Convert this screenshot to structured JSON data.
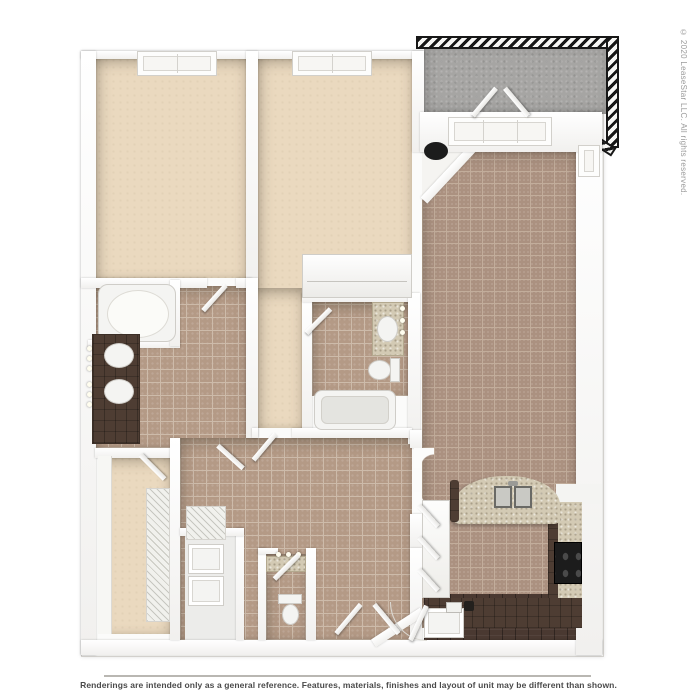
{
  "image": {
    "type": "3d-apartment-floor-plan-rendering",
    "disclaimer": "Renderings are intended only as a general reference. Features, materials, finishes and layout of unit may be different than shown.",
    "copyright": "© 2020 LeaseStar LLC. All rights reserved."
  },
  "floorplan": {
    "rooms": [
      "bedroom-1",
      "bedroom-2",
      "living-dining-room",
      "kitchen",
      "master-bathroom",
      "bathroom-2",
      "walk-in-closet",
      "laundry-closet",
      "powder-room",
      "entry-foyer",
      "hallway",
      "balcony"
    ],
    "fixtures": [
      "bathtub",
      "garden-tub",
      "double-sink-vanity",
      "vanity-sink",
      "toilet",
      "toilet",
      "kitchen-island-double-sink",
      "range",
      "dishwasher",
      "washer-dryer",
      "wire-shelving",
      "french-doors",
      "round-table",
      "balcony-railing"
    ]
  },
  "colors": {
    "page_bg": "#ffffff",
    "wall": "#fbfbfa",
    "wall_edge": "#d5d3cf",
    "carpet": "#ead9bf",
    "bath_tile": "#b49a86",
    "bath_grout": "#cdbbaa",
    "living_tile": "#ab9180",
    "living_grout": "#c2ad9b",
    "balcony_concrete": "#a6a5a3",
    "railing_dark": "#171717",
    "counter_dark": "#4e3d33",
    "granite": "#d3cab4",
    "wood_floor": "#4a3931",
    "appliance_black": "#1c1c1c",
    "fixture_white": "#f4f4f2",
    "text_gray": "#4a4a4a",
    "copyright_gray": "#9b9b9b"
  }
}
